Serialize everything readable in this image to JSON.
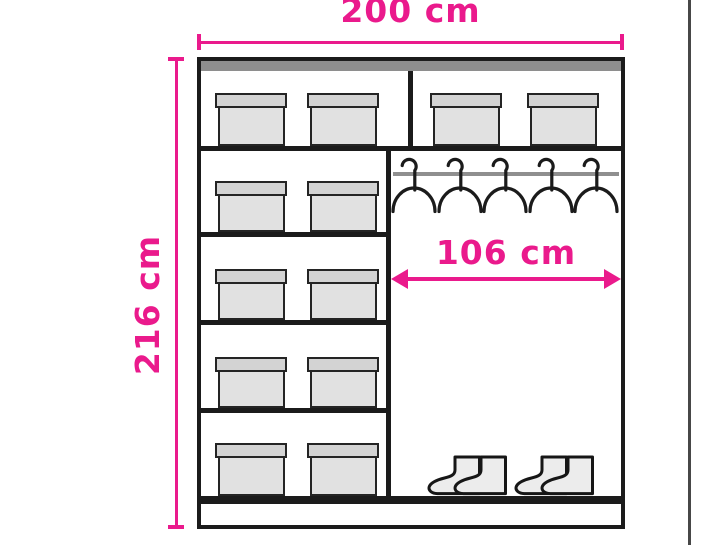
{
  "diagram": {
    "title": "wardrobe interior dimension diagram",
    "labels": {
      "width": "200 cm",
      "height": "216 cm",
      "interior_width": "106 cm"
    },
    "structure": {
      "top_row_box_count": 4,
      "left_column_box_rows": 4,
      "left_column_boxes_per_row": 2,
      "total_boxes": 12,
      "hanger_count": 5,
      "boot_pair_count": 2
    },
    "colors": {
      "accent": "#ea1a8c",
      "outline": "#1b1b1b",
      "top_panel": "#8e8e8e",
      "hanging_rail": "#8f8f8f",
      "box_lid": "#d3d3d3",
      "box_body": "#e1e1e1",
      "boot_fill": "#ececec",
      "page_edge": "#474747"
    }
  }
}
